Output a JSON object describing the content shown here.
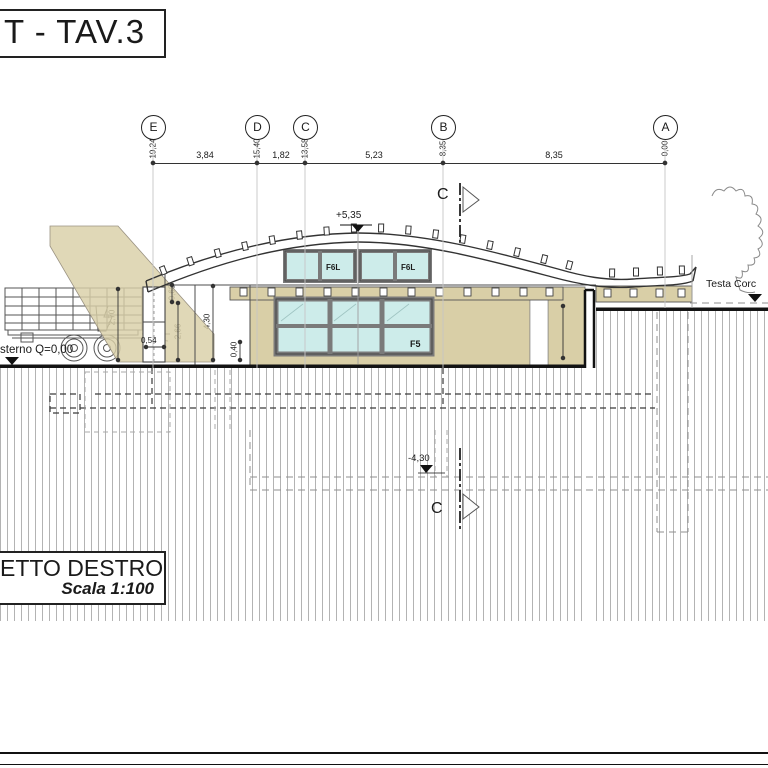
{
  "titles": {
    "sheet": "T - TAV.3",
    "view": "ETTO DESTRO",
    "scale": "Scala 1:100"
  },
  "grid": {
    "columns": [
      {
        "label": "E",
        "offset": "19,24"
      },
      {
        "label": "D",
        "offset": "15,40"
      },
      {
        "label": "C",
        "offset": "13,58"
      },
      {
        "label": "B",
        "offset": "8,35"
      },
      {
        "label": "A",
        "offset": "0,00"
      }
    ],
    "spans": [
      "3,84",
      "1,82",
      "5,23",
      "8,35"
    ]
  },
  "section": {
    "label": "C"
  },
  "elevations": {
    "apex": "+5,35",
    "foundation": "-4,30",
    "ground_note": "sterno Q=0,00",
    "testa_note": "Testa Corc"
  },
  "dims": {
    "truck_height": "2,70",
    "plinth_width": "0,54",
    "clear_left": "2,66",
    "roof_edge": "0,68",
    "wall_height": "4,30",
    "sill_height": "0,40",
    "right_wall": "2,10",
    "centerline": "5,35"
  },
  "windows": {
    "clerestory": "F6L",
    "main": "F5"
  },
  "colors": {
    "beige": "#d9cfa7",
    "glass": "#cdecea",
    "frame": "#7a7a7a",
    "line": "#333333"
  }
}
